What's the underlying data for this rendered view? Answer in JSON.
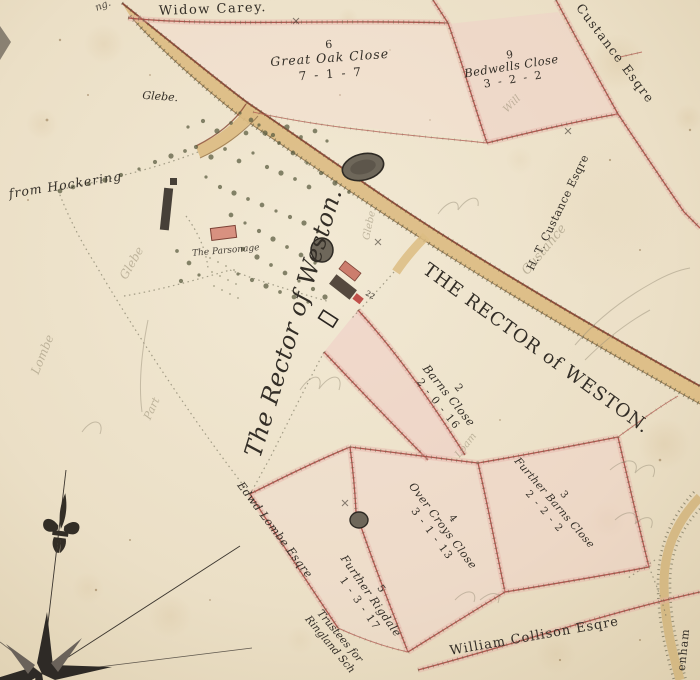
{
  "map": {
    "titles": {
      "widow_carey": "Widow Carey.",
      "rector_script": "The Rector of Weston.",
      "rector_caps": "THE RECTOR of WESTON."
    },
    "owners": {
      "custance_top": "Custance Esqre",
      "custance_mid": "H. T. Custance Esqre",
      "lombe": "Edwd Lombe Esqre",
      "collison": "William Collison Esqre",
      "trustees_line1": "Trustees for",
      "trustees_line2": "Ringland Sch"
    },
    "places": {
      "glebe": "Glebe.",
      "from_hockering": "from Hockering",
      "parsonage": "The Parsonage",
      "road_right_fragment": "enham",
      "corner_fragment": "ng."
    },
    "fields": {
      "great_oak": {
        "number": "6",
        "name": "Great Oak Close",
        "area": "7 - 1 - 7"
      },
      "bedwells": {
        "number": "9",
        "name": "Bedwells Close",
        "area": "3 - 2 - 2"
      },
      "barns": {
        "number": "2",
        "name": "Barns Close",
        "area": "2 - 0 - 16"
      },
      "over_croys": {
        "number": "4",
        "name": "Over Croys Close",
        "area": "3 - 1 - 13"
      },
      "further_barns": {
        "number": "3",
        "name": "Further Barns Close",
        "area": "2 - 2 - 2"
      },
      "further_rigdale": {
        "number": "5",
        "name": "Further Rigdale",
        "area": "1 - 3 - 17"
      }
    },
    "plot_mark": "22",
    "pencil_notes": {
      "custance": "Custance",
      "lombe": "Lombe",
      "glebe_west": "Glebe",
      "part": "Part",
      "glebe_road": "Glebe",
      "loam": "Loam",
      "will": "Will"
    },
    "colors": {
      "paper": "#ebdfc6",
      "road_fill": "#dcbc83",
      "road_edge": "#7c3526",
      "boundary_red": "#a84a42",
      "pink_wash": "#f0d0c8",
      "ink": "#332e27",
      "pencil": "#978d74",
      "pond": "#6e675a",
      "tree": "#5d5f43"
    }
  }
}
